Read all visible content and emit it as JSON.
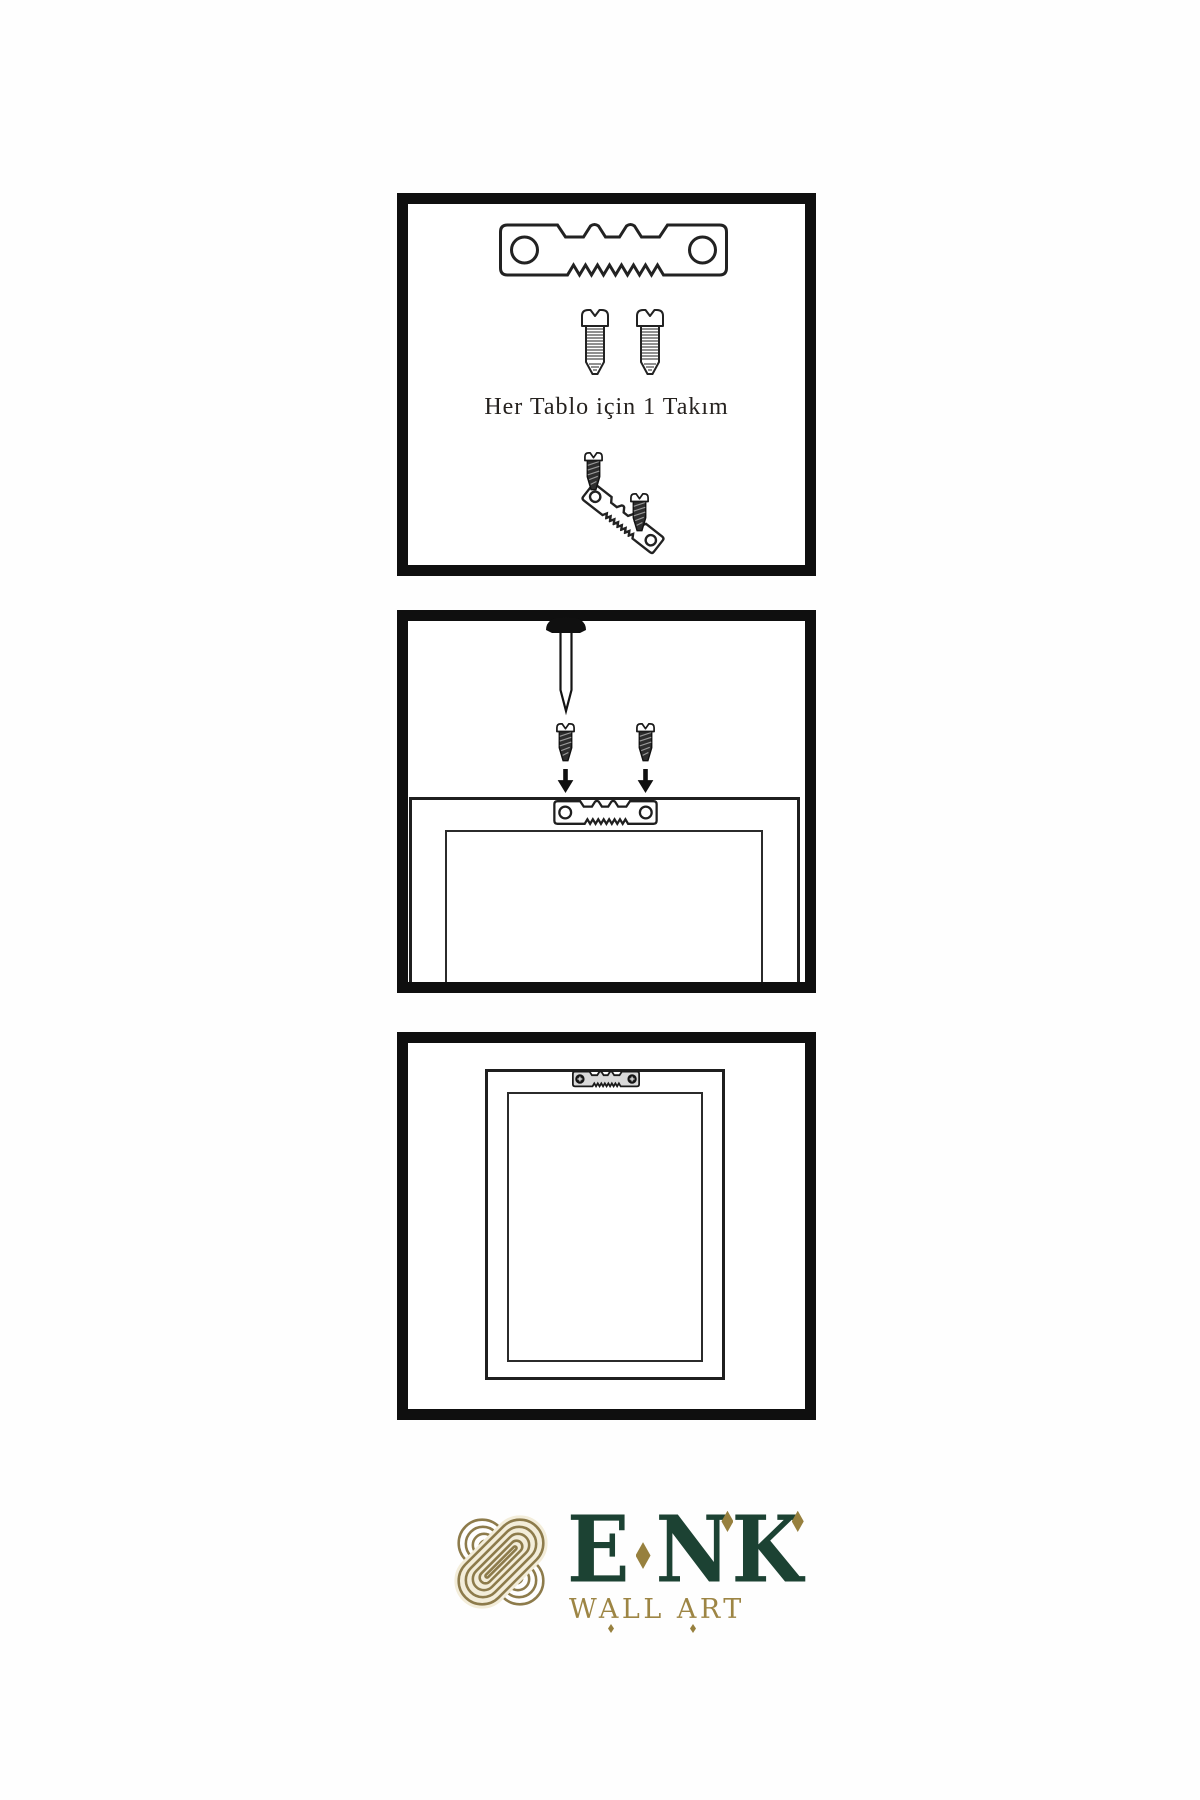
{
  "panels": {
    "kit": {
      "caption": "Her Tablo için 1 Takım",
      "icons": [
        "sawtooth-hanger-icon",
        "machine-screw-icon",
        "machine-screw-icon",
        "dark-screw-icon",
        "tilted-sawtooth-hanger-icon",
        "dark-screw-icon"
      ]
    },
    "install": {
      "icons": [
        "wall-nail-icon",
        "dark-screw-icon",
        "dark-screw-icon",
        "arrow-down-icon",
        "arrow-down-icon",
        "sawtooth-hanger-icon",
        "frame-back-outline"
      ]
    },
    "result": {
      "icons": [
        "mounted-sawtooth-hanger-icon",
        "phillips-screw-head-icon",
        "phillips-screw-head-icon",
        "frame-back-outline"
      ]
    }
  },
  "brand": {
    "letters": [
      "E",
      "N",
      "K"
    ],
    "tagline": "WALL ART",
    "logo_icon": "interlocked-knot-icon"
  },
  "colors": {
    "line": "#1f1f1f",
    "panel_border": "#0f0f0f",
    "brand_green": "#1c4233",
    "brand_gold": "#97803e",
    "tagline_gold": "#9d8544",
    "knot_gold": "#8d7b4b",
    "knot_cream": "#f3edda",
    "screw_dark": "#2e2e2e",
    "hanger_gray": "#d9d9d9",
    "background": "#fefefe"
  }
}
